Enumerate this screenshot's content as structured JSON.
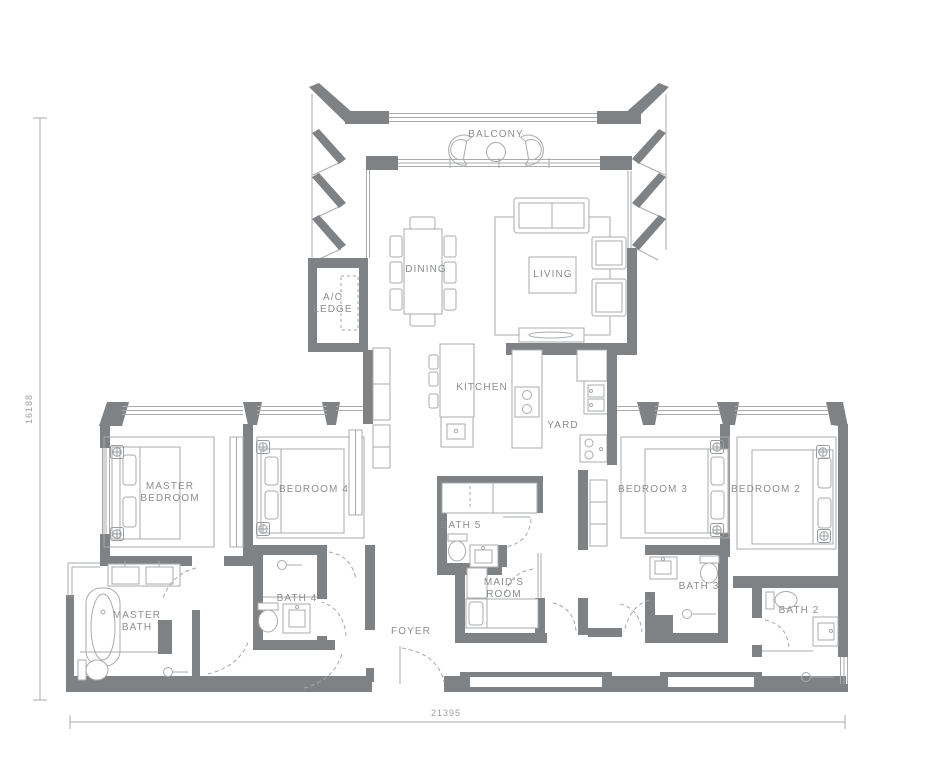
{
  "colors": {
    "wall": "#7f8285",
    "line": "#a9abad",
    "text": "#8a8d90",
    "door_arc": "#a4a7a9",
    "dimension_text": "#9b9ea1",
    "background": "#ffffff"
  },
  "rooms": {
    "balcony": "BALCONY",
    "dining": "DINING",
    "living": "LIVING",
    "ac_ledge_line1": "A/C",
    "ac_ledge_line2": "LEDGE",
    "kitchen": "KITCHEN",
    "yard": "YARD",
    "master_bedroom_line1": "MASTER",
    "master_bedroom_line2": "BEDROOM",
    "bedroom4": "BEDROOM 4",
    "bedroom3": "BEDROOM 3",
    "bedroom2": "BEDROOM 2",
    "bath5": "BATH 5",
    "bath4": "BATH 4",
    "bath3": "BATH 3",
    "bath2": "BATH 2",
    "maids_room_line1": "MAID'S",
    "maids_room_line2": "ROOM",
    "master_bath_line1": "MASTER",
    "master_bath_line2": "BATH",
    "foyer": "FOYER"
  },
  "dimensions": {
    "vertical": "16188",
    "horizontal": "21395"
  }
}
